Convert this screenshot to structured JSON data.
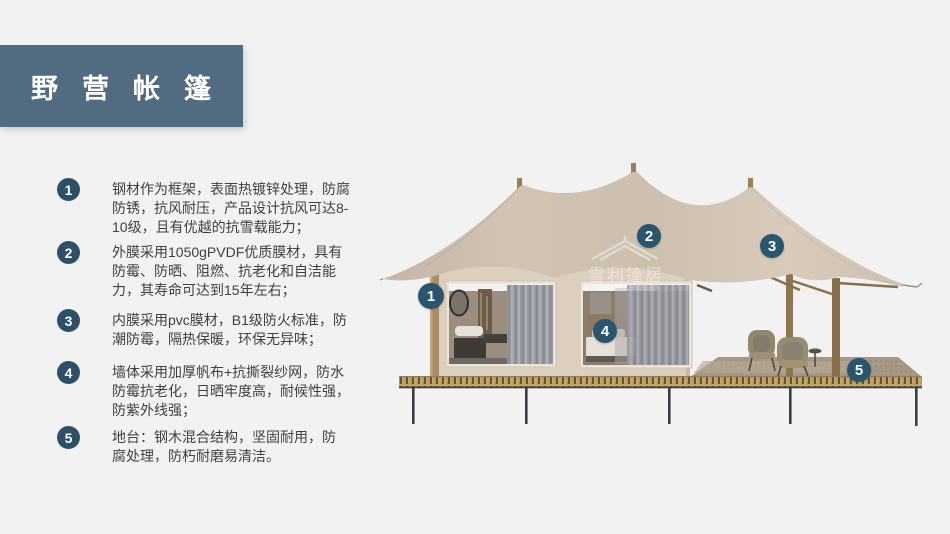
{
  "title": "野营帐篷",
  "features": [
    {
      "num": "1",
      "lines": [
        "钢材作为框架，表面热镀锌处理，防腐",
        "防锈，抗风耐压，产品设计抗风可达8-",
        "10级，且有优越的抗雪载能力；"
      ]
    },
    {
      "num": "2",
      "lines": [
        "外膜采用1050gPVDF优质膜材，具有",
        "防霉、防晒、阻燃、抗老化和自洁能",
        "力，其寿命可达到15年左右；"
      ]
    },
    {
      "num": "3",
      "lines": [
        "内膜采用pvc膜材，B1级防火标准，防",
        "潮防霉，隔热保暖，环保无异味；"
      ]
    },
    {
      "num": "4",
      "lines": [
        "墙体采用加厚帆布+抗撕裂纱网，防水",
        "防霉抗老化，日晒牢度高，耐候性强，",
        "防紫外线强；"
      ]
    },
    {
      "num": "5",
      "lines": [
        "地台：钢木混合结构，坚固耐用，防",
        "腐处理，防朽耐磨易清洁。"
      ]
    }
  ],
  "callouts": [
    {
      "label": "1"
    },
    {
      "label": "2"
    },
    {
      "label": "3"
    },
    {
      "label": "4"
    },
    {
      "label": "5"
    }
  ],
  "watermark": "雪利篷居",
  "colors": {
    "background": "#f2f2f3",
    "title_bar": "#516b80",
    "list_number_circle": "#2b5068",
    "callout_badge": "#29566e",
    "roof_canvas": "#d2c4b4",
    "wall": "#ddcfbd",
    "deck_stripe_gold": "#c7a360",
    "text": "#3e4043"
  }
}
